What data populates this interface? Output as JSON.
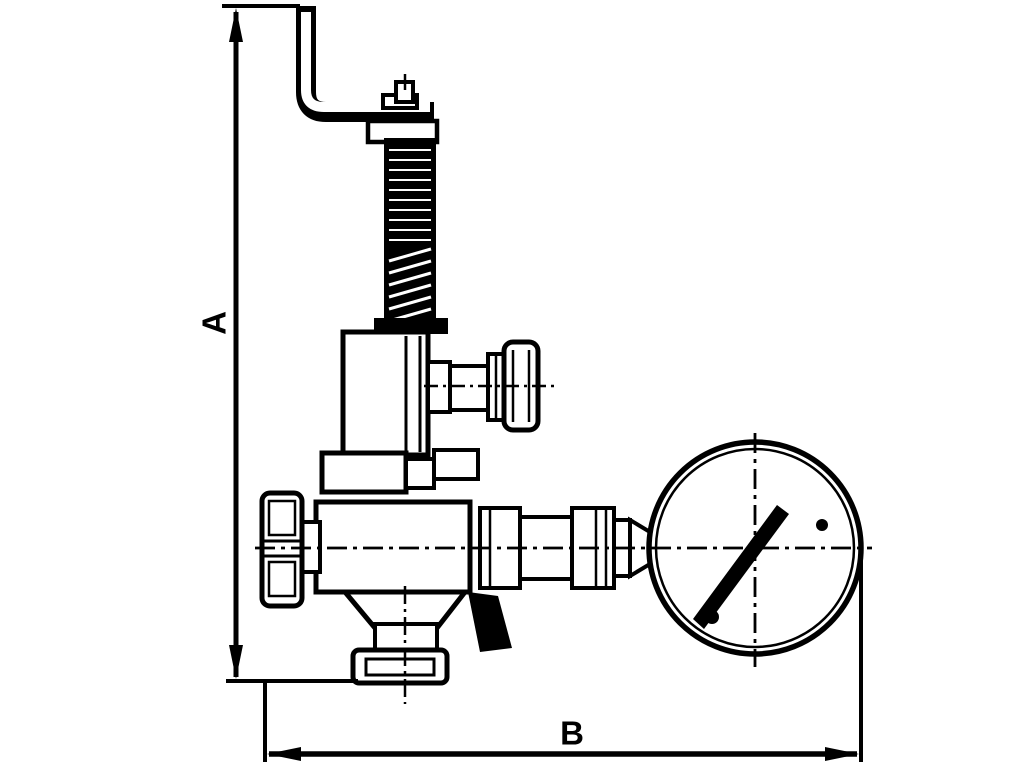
{
  "diagram": {
    "type": "technical-line-drawing",
    "subject": "Overflow / safety valve with test lever, side seal plug, hand knob, bottom outlet flange and attached pressure gauge (side view)",
    "colors": {
      "line": "#000000",
      "background": "#ffffff"
    },
    "dimensions": {
      "vertical_label": "A",
      "horizontal_label": "B"
    },
    "components": [
      "test-lever",
      "spindle-spring-column",
      "spring-bonnet",
      "side-seal-knob",
      "bonnet-flange-nut",
      "hand-knob",
      "valve-body",
      "outlet-flange",
      "gauge-coupling",
      "pressure-gauge"
    ]
  }
}
